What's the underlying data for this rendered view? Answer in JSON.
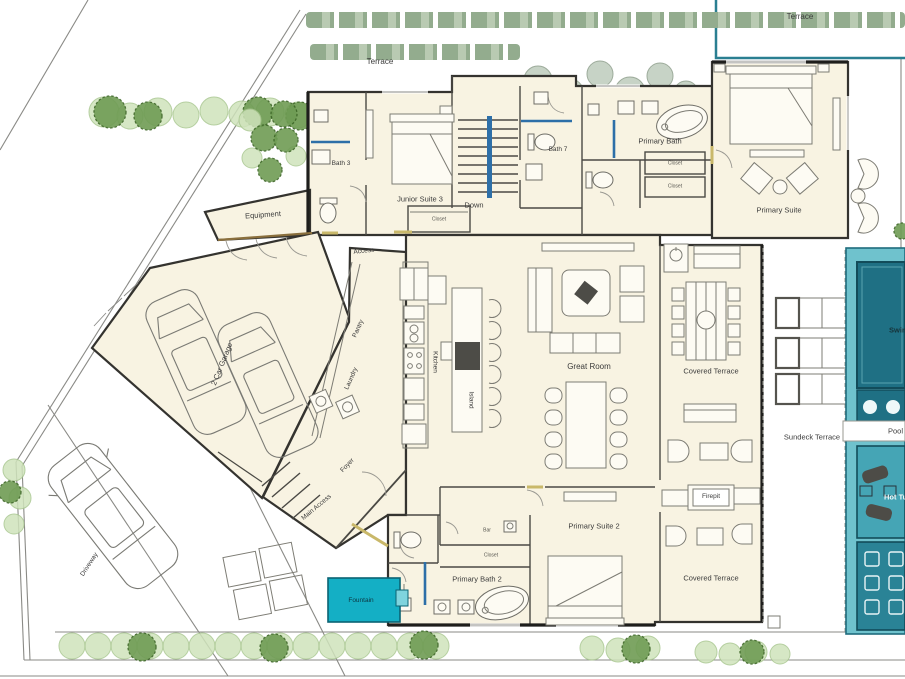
{
  "labels": {
    "terrace_top": "Terrace",
    "terrace_upper_right": "Terrace",
    "bath_3": "Bath 3",
    "junior_suite_3": "Junior Suite 3",
    "junior_closet": "Closet",
    "stairs_down": "Down",
    "bath_7": "Bath 7",
    "primary_bath": "Primary Bath",
    "closet_a": "Closet",
    "closet_b": "Closet",
    "primary_suite": "Primary Suite",
    "equipment": "Equipment",
    "access": "Access",
    "garage": "2 Car Garage",
    "pantry": "Pantry",
    "laundry": "Laundry",
    "kitchen": "Kitchen",
    "island": "Island",
    "great_room": "Great Room",
    "covered_terrace_upper": "Covered Terrace",
    "sundeck_terrace": "Sundeck Terrace",
    "foyer": "Foyer",
    "main_access": "Main Access",
    "fountain": "Fountain",
    "bar": "Bar",
    "hall_closet": "Closet",
    "primary_suite_2": "Primary Suite 2",
    "primary_bath_2": "Primary Bath 2",
    "firepit": "Firepit",
    "covered_terrace_lower": "Covered Terrace",
    "driveway": "Driveway",
    "swimming_pool": "Swimming Pool",
    "pool": "Pool",
    "hot_tub": "Hot Tub"
  },
  "colors": {
    "floor": "#f8f3e2",
    "wall": "#34332f",
    "window_blue": "#2d6fa8",
    "door_sill": "#c9b86a",
    "terrace_border": "#2a7f91",
    "pool_deck": "#6fc2cd",
    "pool_dark": "#1f7084",
    "pool_mid": "#45a5b5",
    "pool_bottom": "#2a8396",
    "fountain": "#14afc5",
    "tree_dark": "#6f9c54",
    "tree_light": "#cfe3bb",
    "tree_gray": "#c2cfc0",
    "hedge_a": "#93ac8e",
    "hedge_b": "#b9cab2"
  }
}
